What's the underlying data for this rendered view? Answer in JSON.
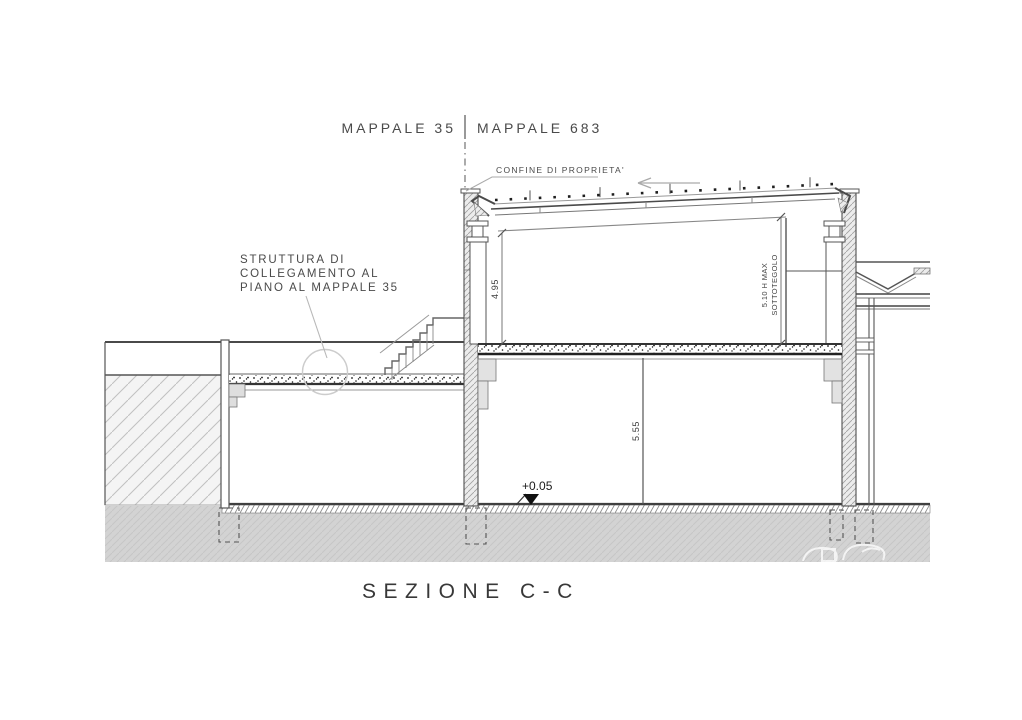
{
  "drawing": {
    "title": "SEZIONE C-C",
    "parcel_labels": {
      "left": "MAPPALE 35",
      "right": "MAPPALE 683"
    },
    "boundary_label": "CONFINE DI PROPRIETA'",
    "annotation": {
      "line1": "STRUTTURA DI",
      "line2": "COLLEGAMENTO AL",
      "line3": "PIANO AL MAPPALE 35"
    },
    "dimensions": {
      "upper_floor_height": "4.95",
      "max_height": "5.10 H MAX",
      "max_height_ref": "SOTTOTEGOLO",
      "ground_floor_height": "5.55",
      "ground_level": "+0.05"
    },
    "colors": {
      "line": "#4a4a4a",
      "ground_fill": "#d3d3d3",
      "earth_hatch": "#c0c0c0",
      "annotation_circle": "#cccccc"
    }
  }
}
